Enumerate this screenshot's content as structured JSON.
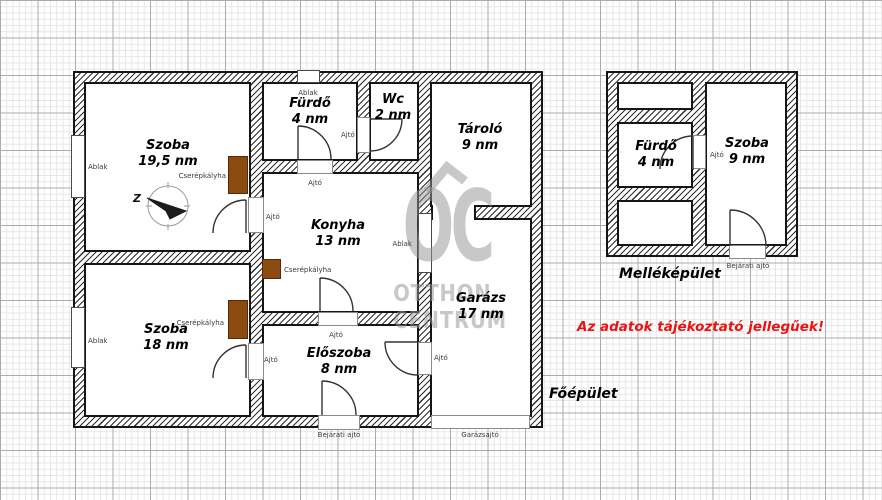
{
  "page": {
    "disclaimer": "Az adatok tájékoztató jellegűek!"
  },
  "watermark": {
    "letters": "OC",
    "line1": "OTTHON",
    "line2": "CENTRUM"
  },
  "buildings": {
    "main": {
      "label": "Főépület",
      "rooms": [
        {
          "id": "szoba1",
          "name": "Szoba",
          "area": "19,5 nm"
        },
        {
          "id": "furdo",
          "name": "Fürdő",
          "area": "4 nm"
        },
        {
          "id": "wc",
          "name": "Wc",
          "area": "2 nm"
        },
        {
          "id": "tarolo",
          "name": "Tároló",
          "area": "9 nm"
        },
        {
          "id": "konyha",
          "name": "Konyha",
          "area": "13 nm"
        },
        {
          "id": "szoba2",
          "name": "Szoba",
          "area": "18 nm"
        },
        {
          "id": "eloszoba",
          "name": "Előszoba",
          "area": "8 nm"
        },
        {
          "id": "garazs",
          "name": "Garázs",
          "area": "17 nm"
        }
      ]
    },
    "annex": {
      "label": "Melléképület",
      "rooms": [
        {
          "id": "furdo2",
          "name": "Fürdő",
          "area": "4 nm"
        },
        {
          "id": "szoba3",
          "name": "Szoba",
          "area": "9 nm"
        }
      ]
    }
  },
  "annotations": {
    "window": "Ablak",
    "door": "Ajtó",
    "entrance_door": "Bejárati ajtó",
    "garage_door": "Garázsajtó",
    "stove": "Cserépkályha",
    "compass_letter": "Z"
  },
  "colors": {
    "stove": "#8a4a10",
    "wall_outline": "#151515",
    "grid_minor": "#e6e6e6",
    "grid_major": "#ababab",
    "watermark": "#969696",
    "disclaimer": "#ee1111"
  }
}
